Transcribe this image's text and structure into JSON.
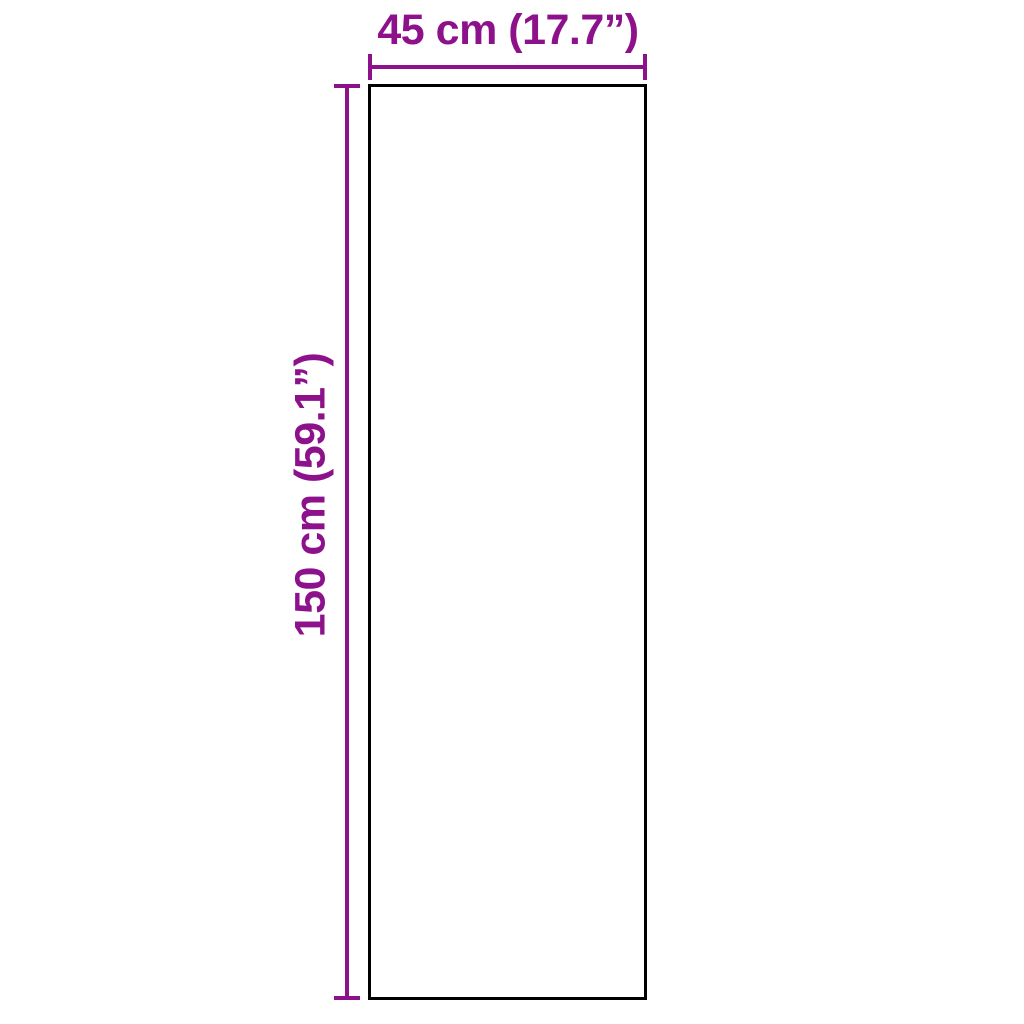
{
  "colors": {
    "background": "#ffffff",
    "accent": "#8E118C",
    "outline": "#000000"
  },
  "diagram": {
    "type": "product-dimension-diagram",
    "shape": "rectangle",
    "width_label": "45 cm (17.7”)",
    "height_label": "150 cm (59.1”)",
    "width_cm": 45,
    "width_in": 17.7,
    "height_cm": 150,
    "height_in": 59.1
  }
}
